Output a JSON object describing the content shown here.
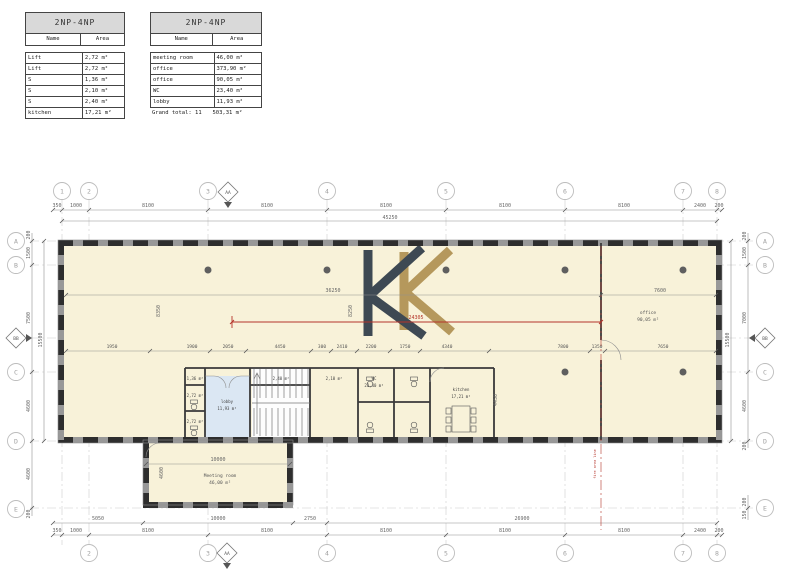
{
  "tables": {
    "left": {
      "title": "2NP-4NP",
      "col_name": "Name",
      "col_area": "Area",
      "rows": [
        {
          "name": "Lift",
          "area": "2,72 m²"
        },
        {
          "name": "Lift",
          "area": "2,72 m²"
        },
        {
          "name": "S",
          "area": "1,36 m²"
        },
        {
          "name": "S",
          "area": "2,10 m²"
        },
        {
          "name": "S",
          "area": "2,40 m²"
        },
        {
          "name": "kitchen",
          "area": "17,21 m²"
        }
      ]
    },
    "right": {
      "title": "2NP-4NP",
      "col_name": "Name",
      "col_area": "Area",
      "rows": [
        {
          "name": "meeting room",
          "area": "46,00 m²"
        },
        {
          "name": "office",
          "area": "373,90 m²"
        },
        {
          "name": "office",
          "area": "90,05 m²"
        },
        {
          "name": "WC",
          "area": "23,40 m²"
        },
        {
          "name": "lobby",
          "area": "11,93 m²"
        }
      ],
      "footer_label": "Grand total: 11",
      "footer_area": "503,31 m²"
    }
  },
  "plan": {
    "grid_top": [
      "1",
      "2",
      "3",
      "4",
      "5",
      "6",
      "7",
      "8"
    ],
    "grid_bottom": [
      "2",
      "3",
      "4",
      "5",
      "6",
      "7",
      "8"
    ],
    "grid_left": [
      "A",
      "B",
      "C",
      "D",
      "E"
    ],
    "grid_right": [
      "A",
      "B",
      "C",
      "D",
      "E"
    ],
    "sections": {
      "top": "AA",
      "bottom": "AA",
      "left": "BB",
      "right": "BB"
    },
    "dims": {
      "top": [
        "350",
        "1000",
        "8100",
        "8100",
        "8100",
        "8100",
        "8100",
        "2400",
        "200"
      ],
      "top_total": "45250",
      "bottom_outer": [
        "350",
        "1000",
        "8100",
        "8100",
        "8100",
        "8100",
        "8100",
        "2400",
        "200"
      ],
      "bottom_inner": [
        "5050",
        "10000",
        "2750",
        "26900"
      ],
      "left": [
        "200",
        "1500",
        "7500",
        "4600",
        "4600",
        "200"
      ],
      "left_total": "15500",
      "right": [
        "200",
        "1500",
        "7000",
        "4600",
        "200",
        "200",
        "150"
      ],
      "right_total": "15500",
      "interior_row": [
        "1950",
        "1900",
        "2050",
        "4450",
        "300",
        "2410",
        "2200",
        "1750",
        "4340",
        "7800",
        "1350",
        "7650"
      ],
      "misc": [
        "36250",
        "7600",
        "8350",
        "8250",
        "4450",
        "10000",
        "4600"
      ],
      "red": "24305"
    },
    "rooms": {
      "office": {
        "name": "office",
        "area": "90,05 m²"
      },
      "lobby": {
        "name": "lobby",
        "area": "11,93 m²"
      },
      "kitchen": {
        "name": "kitchen",
        "area": "17,21 m²"
      },
      "wc": {
        "name": "WC",
        "area": "23,40 m²"
      },
      "meeting": {
        "name": "Meeting room",
        "area": "46,00 m²"
      },
      "small": [
        "1,36 m²",
        "2,72 m²",
        "2,72 m²",
        "2,40 m²",
        "2,10 m²"
      ]
    },
    "fire_note": "fire area line",
    "colors": {
      "floor": "#f8f2d9",
      "lobby": "#dbe7f3",
      "wall": "#3a3a3a",
      "window": "#2e2e2e",
      "red": "#b5342a",
      "logo_dark": "#3e4953",
      "logo_gold": "#b5985c"
    }
  }
}
